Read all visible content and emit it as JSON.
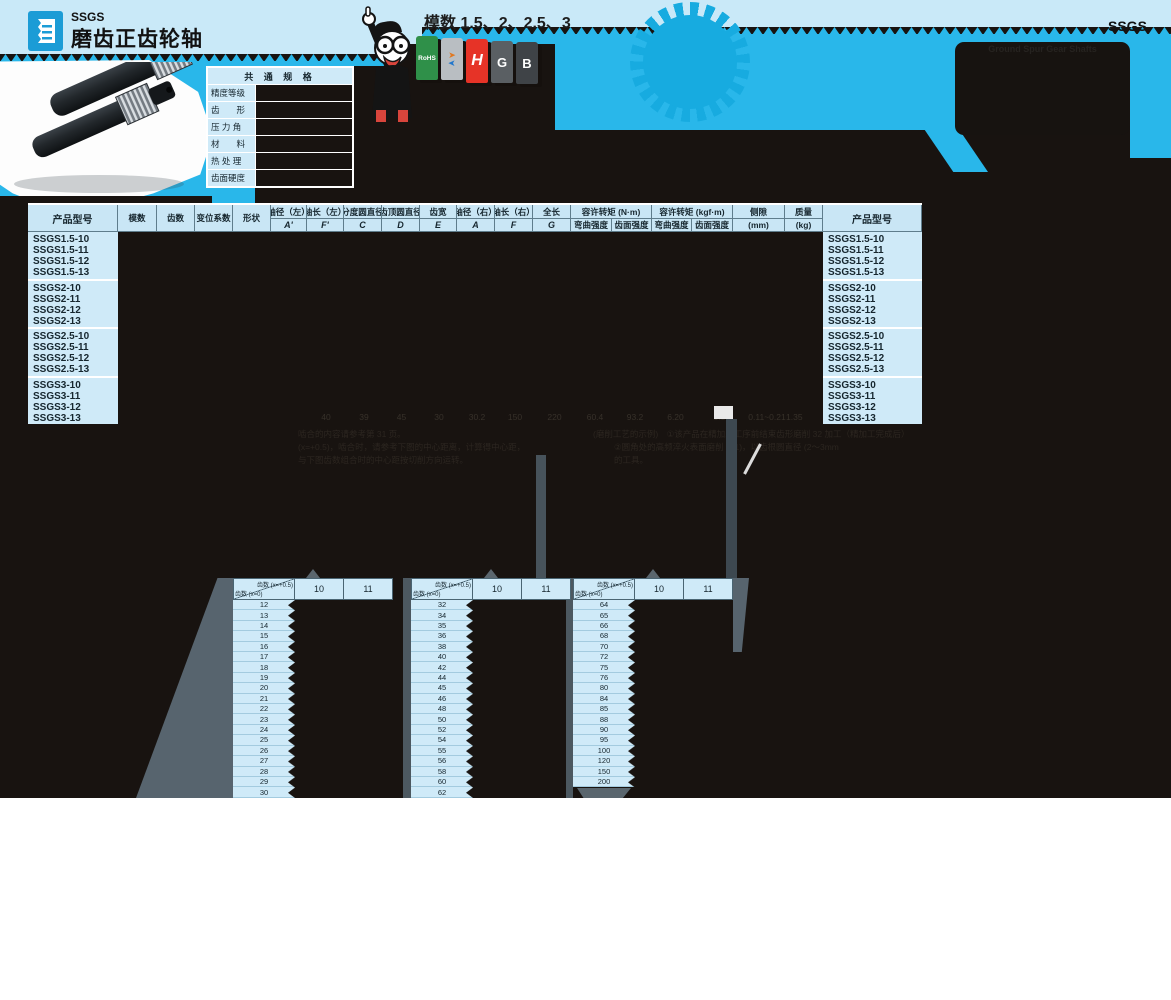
{
  "banner": {
    "series_code": "SSGS",
    "title": "磨齿正齿轮轴",
    "module_note": "模数 1.5、2、2.5、3",
    "corner_code": "SSGS",
    "box_faint_label": "Ground Spur Gear Shafts",
    "badges": {
      "rohs": "RoHS",
      "h": "H",
      "g": "G",
      "b": "B"
    }
  },
  "common_specs": {
    "title": "共 通 规 格",
    "rows": [
      "精度等级",
      "齿　　形",
      "压 力 角",
      "材　　料",
      "热 处 理",
      "齿面硬度"
    ]
  },
  "main_table": {
    "col_product": "产品型号",
    "col_module": "模数",
    "col_teeth": "齿数",
    "col_shift": "变位系数",
    "col_shape": "形状",
    "dims": [
      {
        "label": "轴径（左）",
        "sub": "A'"
      },
      {
        "label": "轴长（左）",
        "sub": "F'"
      },
      {
        "label": "分度圆直径",
        "sub": "C"
      },
      {
        "label": "齿顶圆直径",
        "sub": "D"
      },
      {
        "label": "齿宽",
        "sub": "E"
      },
      {
        "label": "轴径（右）",
        "sub": "A"
      },
      {
        "label": "轴长（右）",
        "sub": "F"
      },
      {
        "label": "全长",
        "sub": "G"
      }
    ],
    "torque_nm": {
      "label": "容许转矩 (N·m)",
      "subs": [
        "弯曲强度",
        "齿面强度"
      ]
    },
    "torque_kgf": {
      "label": "容许转矩 (kgf·m)",
      "subs": [
        "弯曲强度",
        "齿面强度"
      ]
    },
    "backlash": {
      "label": "侧隙",
      "sub": "(mm)"
    },
    "mass": {
      "label": "质量",
      "sub": "(kg)"
    },
    "groups": [
      [
        "SSGS1.5-10",
        "SSGS1.5-11",
        "SSGS1.5-12",
        "SSGS1.5-13"
      ],
      [
        "SSGS2-10",
        "SSGS2-11",
        "SSGS2-12",
        "SSGS2-13"
      ],
      [
        "SSGS2.5-10",
        "SSGS2.5-11",
        "SSGS2.5-12",
        "SSGS2.5-13"
      ],
      [
        "SSGS3-10",
        "SSGS3-11",
        "SSGS3-12",
        "SSGS3-13"
      ]
    ],
    "faint_last_row": [
      "40",
      "39",
      "45",
      "30",
      "30.2",
      "150",
      "220",
      "60.4",
      "93.2",
      "6.20",
      "9.51",
      "0.11~0.21",
      "1.35"
    ]
  },
  "faint_notes": {
    "left1": "啮合的内容请参考第 31 页。",
    "left2": "(x=+0.5)，啮合时，请参考下图的中心距离，计算得中心距，",
    "left3": "与下图齿数组合时的中心距按切削方向运转。",
    "right1": "(磨削工艺的示例)　①该产品在精加工工序前结束齿形磨削 32 加工（精加工完成后）",
    "right2": "②圆角处的高频淬火表面磨削 X(1)，以齿根圆直径 (2～3mm",
    "right3": "的工具。"
  },
  "tooth_tables": {
    "diag_top": "齿数 (x=+0.5)",
    "diag_bottom": "齿数 (x=0)",
    "value_cols": [
      "10",
      "11"
    ],
    "tables": [
      {
        "rows": [
          12,
          13,
          14,
          15,
          16,
          17,
          18,
          19,
          20,
          21,
          22,
          23,
          24,
          25,
          26,
          27,
          28,
          29,
          30
        ]
      },
      {
        "rows": [
          32,
          34,
          35,
          36,
          38,
          40,
          42,
          44,
          45,
          46,
          48,
          50,
          52,
          54,
          55,
          56,
          58,
          60,
          62
        ]
      },
      {
        "rows": [
          64,
          65,
          66,
          68,
          70,
          72,
          75,
          76,
          80,
          84,
          85,
          88,
          90,
          95,
          100,
          120,
          150,
          200
        ]
      }
    ]
  }
}
